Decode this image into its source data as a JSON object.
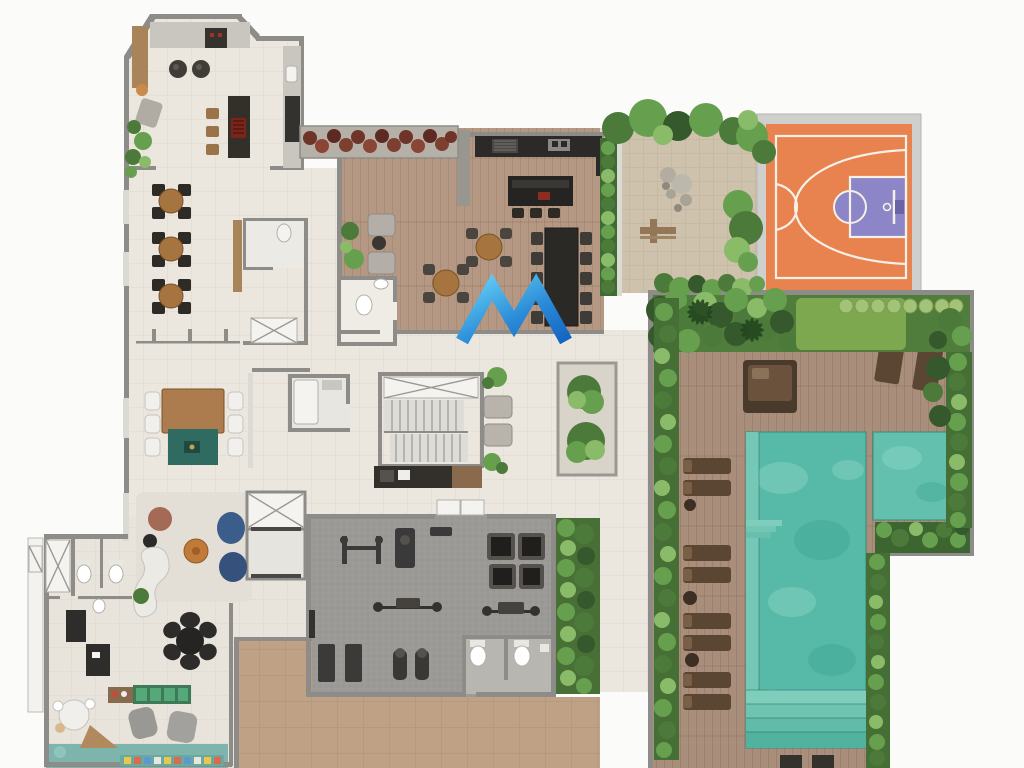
{
  "image": {
    "kind": "real-estate floor plan rendering",
    "floor": "amenity / leisure deck top view"
  },
  "watermark": {
    "name": "m-monogram-watermark",
    "shape": "double-chevron letter M",
    "gradient_start": "#62cdf5",
    "gradient_end": "#1464c0"
  },
  "palette": {
    "bg": "#fbfbfa",
    "wall": "#8e8c88",
    "wallLight": "#dcdad4",
    "tile": "#ebe7df",
    "deck": "#b49883",
    "poolDeck": "#a98e7b",
    "gravel": "#cec2ad",
    "gymFloor": "#9c9a96",
    "tan": "#bfa286",
    "water": "#57b9a7",
    "waterB": "#63c0ae",
    "courtOrange": "#e8834f",
    "courtPurple": "#8c85c8",
    "courtLine": "#f6f0e6",
    "kidsTeal": "#7db5ac",
    "kidsGreen": "#55a877",
    "sofaBlue": "#3c5c8a",
    "poufRust": "#a56a55",
    "loungerBrown": "#5b4634",
    "redPlanter": "#7a3a2c",
    "logo1": "#62cdf5",
    "logo2": "#1464c0"
  },
  "areas": {
    "plan": "amenity floor plan",
    "kitchen": "gourmet kitchen and party room",
    "dining": "dining lounge with round tables",
    "greatroom": "great room with communal table",
    "deck": "barbecue wooden deck",
    "garden": "zen garden with stones",
    "court": "basketball half court",
    "pooldeck": "pool deck with loungers",
    "pool": "swimming pool",
    "spa": "spa pool",
    "gym": "fitness room",
    "stairs": "stair core",
    "elevator": "elevator bank",
    "lounge": "reading lounge",
    "kids": "kids playroom",
    "terrace": "south terrace"
  }
}
